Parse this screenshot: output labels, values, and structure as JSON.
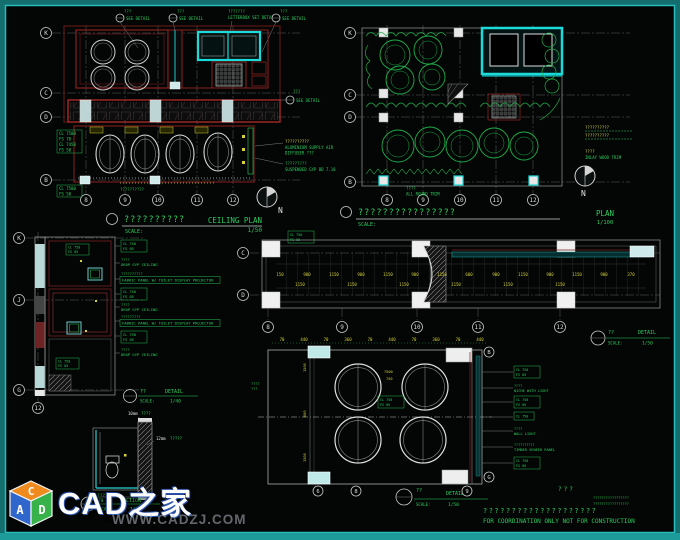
{
  "watermark": {
    "cube": {
      "top": "C",
      "left": "A",
      "right": "D"
    },
    "site_name": "CAD之家",
    "site_url": "WWW.CADZJ.COM"
  },
  "footer": {
    "stamp": "???",
    "tiny_line1": "?????????????????",
    "tiny_line2": "?????????????????",
    "note_cn": "????????????????????",
    "note_en": "FOR COORDINATION ONLY NOT FOR CONSTRUCTION"
  },
  "ceiling_plan": {
    "callouts": [
      {
        "tag": "???",
        "label": "SEE DETAIL"
      },
      {
        "tag": "???",
        "label": "SEE DETAIL"
      },
      {
        "tag": "???????",
        "label": "LETTERBOX SET DETAIL"
      },
      {
        "tag": "???",
        "label": "SEE DETAIL"
      }
    ],
    "side_callout": {
      "tag": "???",
      "label": "SEE DETAIL"
    },
    "rows": [
      "K",
      "C",
      "D",
      "B"
    ],
    "cols": [
      "8",
      "9",
      "10",
      "11",
      "12"
    ],
    "tag_upper": [
      "CL 7500",
      "FS 70",
      "CL 7450",
      "FS 50"
    ],
    "tag_lower": [
      "CL 7500",
      "FS 50"
    ],
    "right_notes": [
      "??????????",
      "ALUMINIUM SUPPLY AIR",
      "DIFFUSER  ???",
      "?????????",
      "SUSPENDED GYP BD  7.10"
    ],
    "under_note": "??????????",
    "title_cn": "??????????",
    "title_en": "CEILING PLAN",
    "scale_label": "SCALE:",
    "scale": "1/50",
    "north": "N"
  },
  "floor_plan": {
    "rows": [
      "K",
      "C",
      "D",
      "B"
    ],
    "cols": [
      "8",
      "9",
      "10",
      "11",
      "12"
    ],
    "note_row1": "??????????",
    "note_row2": "??????????",
    "right_tag": {
      "tag": "????",
      "label": "INLAY WOOD TRIM"
    },
    "bottom_tag": {
      "tag": "????",
      "label": "ALL ROUND TRIM"
    },
    "title_cn": "????????????????",
    "title_en": "PLAN",
    "scale_label": "SCALE:",
    "scale": "1/100",
    "north": "N"
  },
  "toilet_detail": {
    "rows": [
      "K",
      "J",
      "G"
    ],
    "col": "12",
    "tag_a": [
      "CL 750",
      "FS 05"
    ],
    "tag_b": [
      "CL 750",
      "FS 05"
    ],
    "ann": [
      {
        "l1": "CL 750",
        "l2": "FS 05"
      },
      {
        "tag": "????",
        "label": "DROP GYP CEILING"
      },
      {
        "tag": "??????????",
        "label": "FABRIC PANEL W/ TOILET DISPLAY PROJECTOR"
      },
      {
        "l1": "CL 750",
        "l2": "FS 05"
      },
      {
        "tag": "????",
        "label": "DROP GYP CEILING"
      },
      {
        "tag": "?????????",
        "label": "FABRIC PANEL W/ TOILET DISPLAY PROJECTOR"
      },
      {
        "l1": "CL 750",
        "l2": "FS 05"
      },
      {
        "tag": "????",
        "label": "DROP GYP CEILING"
      }
    ],
    "title": {
      "tag": "??",
      "name": "DETAIL",
      "scale_label": "SCALE:",
      "scale": "1/40"
    }
  },
  "corridor_detail": {
    "rows": [
      "C",
      "D"
    ],
    "cols": [
      "8",
      "9",
      "10",
      "11",
      "12"
    ],
    "tag": [
      "CL 750",
      "FS 05"
    ],
    "dims": [
      "150",
      "900",
      "1150",
      "900",
      "1150",
      "900",
      "1150",
      "600",
      "900",
      "1150",
      "900",
      "1150",
      "900",
      "370"
    ],
    "dims2": [
      "1150",
      "1150",
      "1150",
      "1150",
      "1150",
      "1150"
    ],
    "title": {
      "tag": "??",
      "name": "DETAIL",
      "scale_label": "SCALE:",
      "scale": "1/50"
    }
  },
  "table_detail": {
    "dims_top": [
      "70",
      "440",
      "70",
      "360",
      "70",
      "440",
      "70",
      "360",
      "70",
      "440"
    ],
    "dims_left": [
      "1500",
      "600",
      "1500"
    ],
    "tag_circle": "7500",
    "tag_circle2": "750",
    "center_tag": [
      "CL 750",
      "FS 05"
    ],
    "left_note": [
      "????",
      "???"
    ],
    "rows": [
      "B",
      "G"
    ],
    "cols": [
      "6",
      "8",
      "9"
    ],
    "ann": [
      {
        "l1": "CL 750",
        "l2": "FS 05"
      },
      {
        "tag": "????",
        "label": "NICHE WITH LIGHT"
      },
      {
        "l1": "CL 750",
        "l2": "FS 05"
      },
      {
        "l1": "CL 750"
      },
      {
        "tag": "????",
        "label": "WALL LIGHT"
      },
      {
        "tag": "??????????",
        "label": "TIMBER VENEER PANEL"
      },
      {
        "l1": "CL 750",
        "l2": "FS 05"
      }
    ],
    "title": {
      "tag": "??",
      "name": "DETAIL",
      "scale_label": "SCALE:",
      "scale": "1/50"
    }
  },
  "section_detail": {
    "note1": {
      "size": "10mm",
      "label": "????"
    },
    "note2": {
      "size": "12mm",
      "label": "?????"
    },
    "dim": "370",
    "title": {
      "tag": "???",
      "name": "SECTION",
      "scale_label": "SCALE:",
      "scale": "1/5"
    }
  }
}
